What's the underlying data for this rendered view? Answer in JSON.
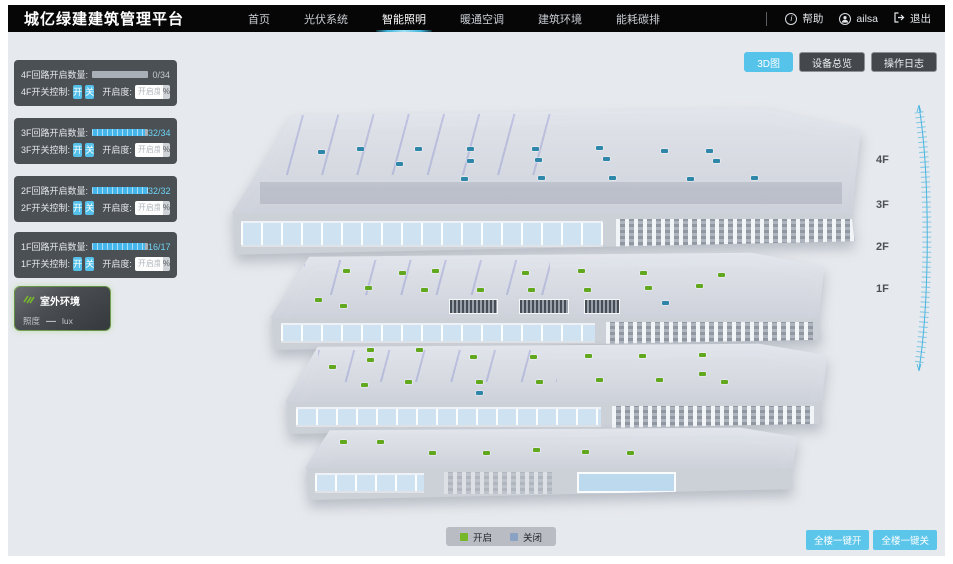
{
  "header": {
    "title": "城亿绿建建筑管理平台",
    "nav": [
      {
        "label": "首页"
      },
      {
        "label": "光伏系统"
      },
      {
        "label": "智能照明",
        "active": true
      },
      {
        "label": "暖通空调"
      },
      {
        "label": "建筑环境"
      },
      {
        "label": "能耗碳排"
      }
    ],
    "help": "帮助",
    "user": "ailsa",
    "logout": "退出"
  },
  "view_buttons": [
    {
      "label": "3D图",
      "active": true
    },
    {
      "label": "设备总览"
    },
    {
      "label": "操作日志"
    }
  ],
  "floor_panels": [
    {
      "count_label": "4F回路开启数量:",
      "value": "0/34",
      "pct": 0,
      "switch_label": "4F开关控制:",
      "on_label": "开",
      "off_label": "关",
      "dim_label": "开启度:",
      "dim_placeholder": "开启度",
      "unit": "%"
    },
    {
      "count_label": "3F回路开启数量:",
      "value": "32/34",
      "pct": 94,
      "switch_label": "3F开关控制:",
      "on_label": "开",
      "off_label": "关",
      "dim_label": "开启度:",
      "dim_placeholder": "开启度",
      "unit": "%"
    },
    {
      "count_label": "2F回路开启数量:",
      "value": "32/32",
      "pct": 100,
      "switch_label": "2F开关控制:",
      "on_label": "开",
      "off_label": "关",
      "dim_label": "开启度:",
      "dim_placeholder": "开启度",
      "unit": "%"
    },
    {
      "count_label": "1F回路开启数量:",
      "value": "16/17",
      "pct": 94,
      "switch_label": "1F开关控制:",
      "on_label": "开",
      "off_label": "关",
      "dim_label": "开启度:",
      "dim_placeholder": "开启度",
      "unit": "%"
    }
  ],
  "outdoor": {
    "title": "室外环境",
    "metric": "照度",
    "value": "—",
    "unit": "lux"
  },
  "legend": [
    {
      "label": "开启",
      "color": "#76b82a"
    },
    {
      "label": "关闭",
      "color": "#8aa3c4"
    }
  ],
  "bulk_buttons": [
    {
      "label": "全楼一键开"
    },
    {
      "label": "全楼一键关"
    }
  ],
  "floor_labels": [
    "4F",
    "3F",
    "2F",
    "1F"
  ],
  "building": {
    "marker_colors": {
      "on": "#61a81e",
      "off": "#2e86a8"
    },
    "floors": [
      {
        "name": "4F",
        "markers": [
          [
            14,
            45,
            0
          ],
          [
            20,
            42,
            0
          ],
          [
            26,
            55,
            0
          ],
          [
            29,
            42,
            0
          ],
          [
            37,
            42,
            0
          ],
          [
            37,
            53,
            0
          ],
          [
            47,
            42,
            0
          ],
          [
            47.5,
            52,
            0
          ],
          [
            57,
            41,
            0
          ],
          [
            58,
            51,
            0
          ],
          [
            67,
            44,
            0
          ],
          [
            74,
            44,
            0
          ],
          [
            75,
            53,
            0
          ],
          [
            81,
            67,
            0
          ],
          [
            36,
            68,
            0
          ],
          [
            48,
            67,
            0
          ],
          [
            59,
            67,
            0
          ],
          [
            71,
            68,
            0
          ]
        ]
      },
      {
        "name": "3F",
        "markers": [
          [
            13,
            28,
            1
          ],
          [
            23,
            31,
            1
          ],
          [
            29,
            28,
            1
          ],
          [
            17,
            53,
            1
          ],
          [
            27,
            56,
            1
          ],
          [
            37,
            56,
            1
          ],
          [
            46,
            56,
            1
          ],
          [
            56,
            56,
            1
          ],
          [
            67,
            53,
            1
          ],
          [
            76,
            50,
            1
          ],
          [
            80,
            34,
            1
          ],
          [
            45,
            31,
            1
          ],
          [
            55,
            28,
            1
          ],
          [
            66,
            31,
            1
          ],
          [
            8,
            70,
            1
          ],
          [
            12.5,
            80,
            1
          ],
          [
            70,
            75,
            0
          ]
        ],
        "vents": [
          [
            32,
            72,
            49
          ],
          [
            44.5,
            72,
            50
          ],
          [
            56,
            72,
            36
          ]
        ]
      },
      {
        "name": "2F",
        "markers": [
          [
            15,
            10,
            1
          ],
          [
            24,
            10,
            1
          ],
          [
            34,
            22,
            1
          ],
          [
            45,
            22,
            1
          ],
          [
            55,
            20,
            1
          ],
          [
            65,
            20,
            1
          ],
          [
            76,
            18,
            1
          ],
          [
            15,
            26,
            1
          ],
          [
            8,
            38,
            1
          ],
          [
            14,
            68,
            1
          ],
          [
            22,
            63,
            1
          ],
          [
            35,
            63,
            1
          ],
          [
            46,
            63,
            1
          ],
          [
            57,
            60,
            1
          ],
          [
            68,
            60,
            1
          ],
          [
            76,
            50,
            1
          ],
          [
            80,
            63,
            1
          ],
          [
            35,
            82,
            0
          ]
        ]
      },
      {
        "name": "1F",
        "markers": [
          [
            7,
            33,
            1
          ],
          [
            14.5,
            33,
            1
          ],
          [
            25,
            60,
            1
          ],
          [
            36,
            60,
            1
          ],
          [
            46,
            52,
            1
          ],
          [
            56,
            57,
            1
          ],
          [
            65,
            60,
            1
          ]
        ]
      }
    ]
  },
  "colors": {
    "nav_bg": "#060607",
    "accent_cyan": "#4fc1e9",
    "panel_bg": "#3e4246",
    "progress_fill": "#45b5ea",
    "value_cyan": "#6fd4f6",
    "stage_bg": "#e6e9ed",
    "outdoor_green": "#76b82a"
  }
}
